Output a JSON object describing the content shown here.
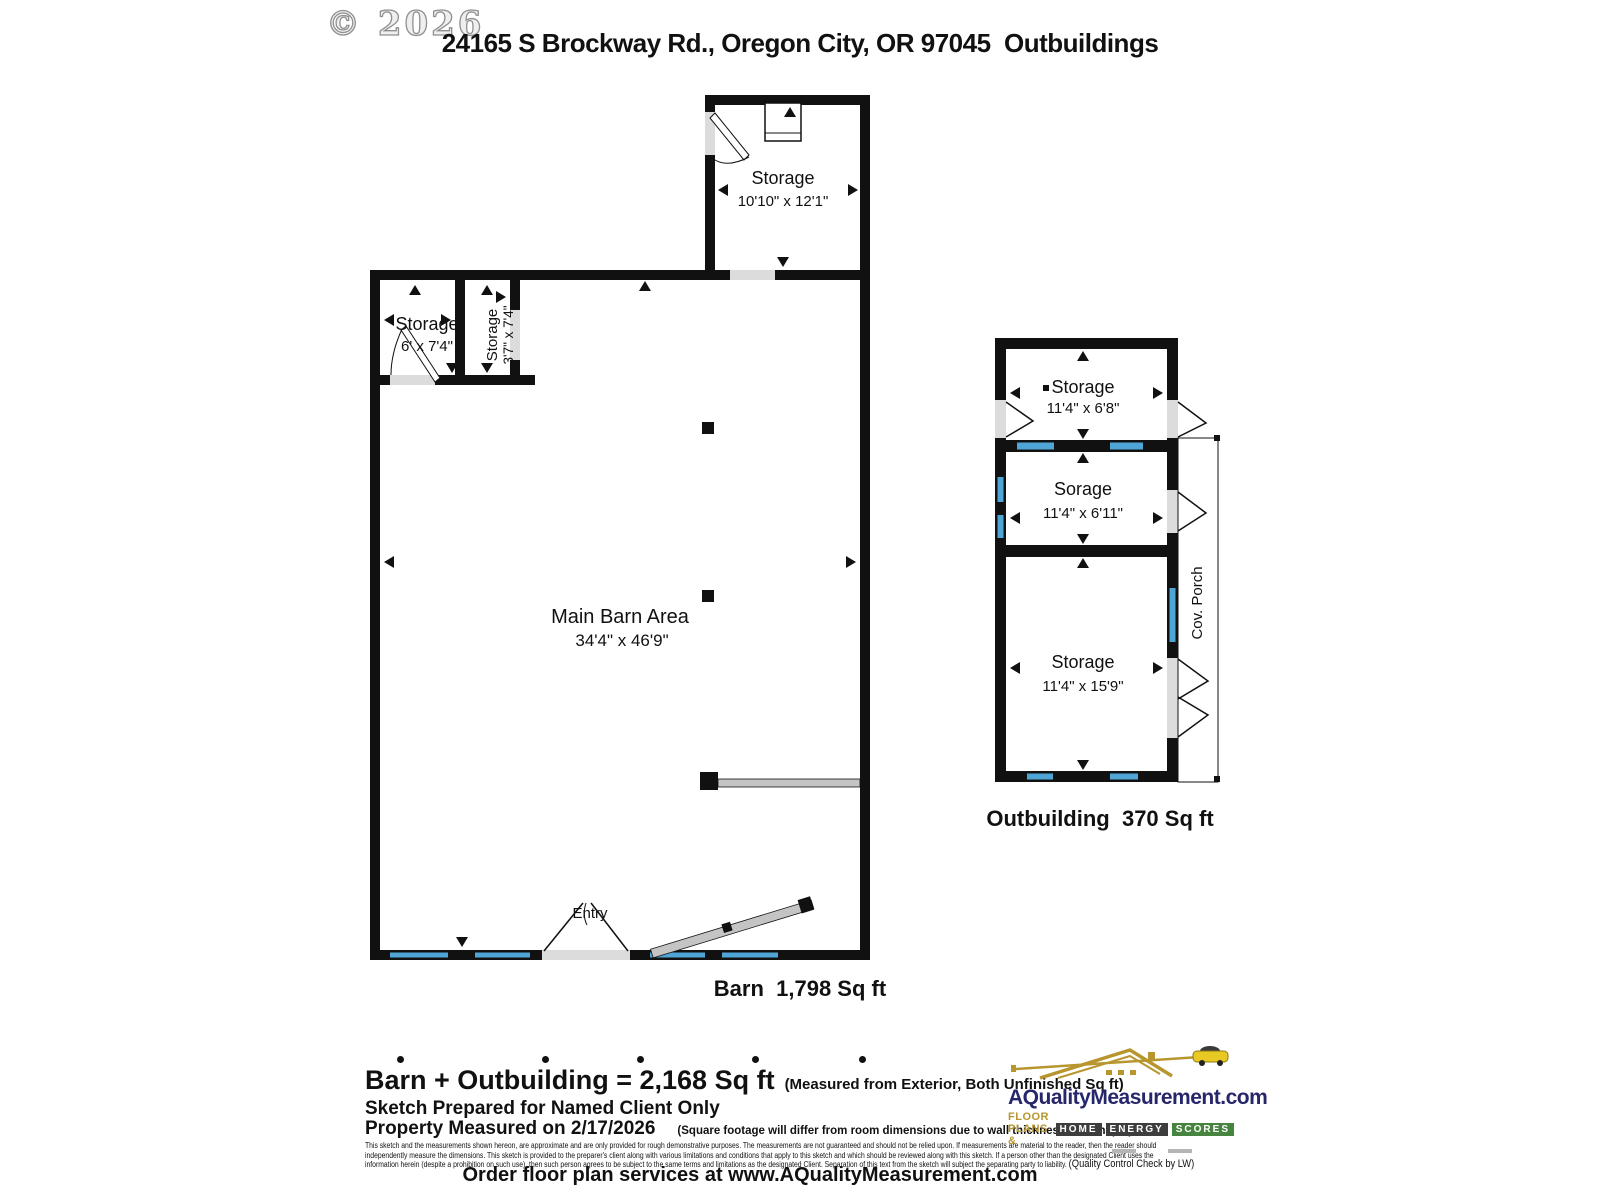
{
  "meta": {
    "copyright": "© 2026",
    "title": "24165 S Brockway Rd., Oregon City, OR 97045  Outbuildings"
  },
  "barn": {
    "caption": "Barn  1,798 Sq ft",
    "entry_label": "Entry",
    "rooms": {
      "top_storage": {
        "name": "Storage",
        "dims": "10'10\" x 12'1\""
      },
      "storage_left": {
        "name": "Storage",
        "dims": "6' x 7'4\""
      },
      "storage_small": {
        "name": "Storage",
        "dims": "3'7\" x 7'4\""
      },
      "main": {
        "name": "Main Barn Area",
        "dims": "34'4\" x 46'9\""
      }
    }
  },
  "outbuilding": {
    "caption": "Outbuilding  370 Sq ft",
    "porch_label": "Cov. Porch",
    "rooms": {
      "storage1": {
        "name": "Storage",
        "dims": "11'4\" x 6'8\""
      },
      "storage2": {
        "name": "Sorage",
        "dims": "11'4\" x 6'11\""
      },
      "storage3": {
        "name": "Storage",
        "dims": "11'4\" x 15'9\""
      }
    }
  },
  "footer": {
    "total_line": "Barn + Outbuilding = 2,168 Sq ft",
    "total_note": "(Measured from Exterior, Both Unfinished Sq ft)",
    "prepared_line": "Sketch Prepared for Named Client Only",
    "measured_line": "Property Measured on 2/17/2026",
    "measured_note": "(Square footage will differ from room dimensions due to wall thickness and shape.)",
    "disclaimer_line1": "This sketch and the measurements shown hereon, are approximate and are only provided for rough demonstrative purposes.  The measurements are not guaranteed and should not be relied upon.  If measurements are material to the reader, then the reader should",
    "disclaimer_line2": "independently measure the dimensions.  This sketch is provided to the preparer's client along with various limitations and conditions that apply to this sketch and which should be reviewed along with this sketch.  If a person other than the designated Client uses the",
    "disclaimer_line3": "information herein (despite a prohibition on such use), then such person agrees to be subject to the same terms and limitations as the designated Client.  Separation of this text from the sketch will subject the separating party to liability. ",
    "qc_note": "(Quality Control Check by LW)",
    "order_line": "Order floor plan services at www.AQualityMeasurement.com"
  },
  "logo": {
    "brand": "AQualityMeasurement.com",
    "tagline_prefix": "FLOOR PLANS &",
    "badges": [
      "HOME",
      "ENERGY",
      "SCORES"
    ]
  },
  "colors": {
    "wall": "#111111",
    "window": "#4FA6D6",
    "sill": "#DCDCDC",
    "navy": "#26266B",
    "gold": "#B8962E",
    "badge_dark": "#3D3D3D",
    "badge_green": "#47843F"
  }
}
